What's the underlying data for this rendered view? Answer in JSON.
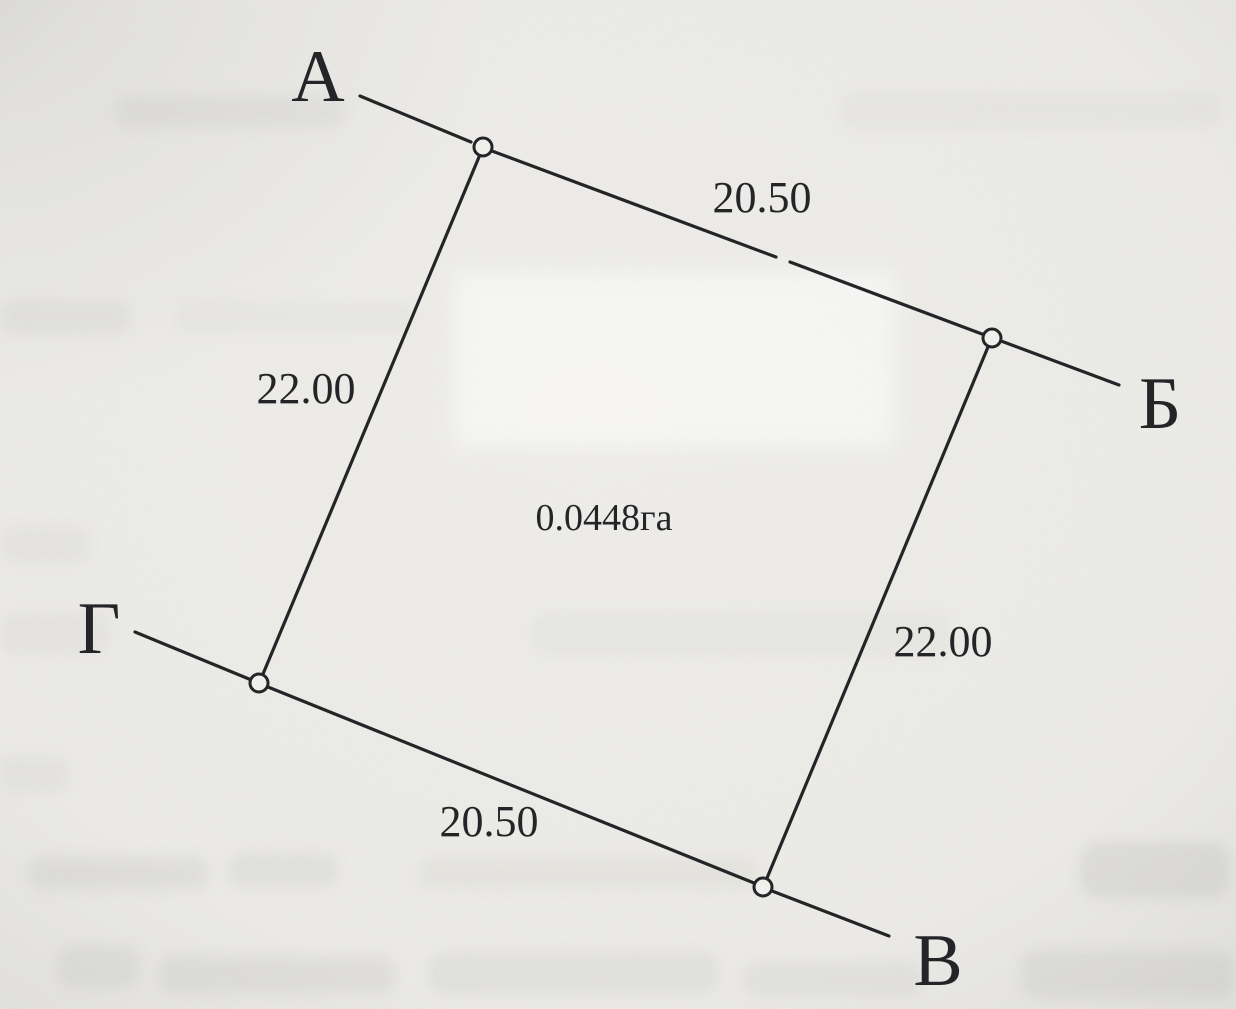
{
  "parcel_plan": {
    "area_label": "0.0448га",
    "corners": {
      "a": "А",
      "b": "Б",
      "v": "В",
      "g": "Г"
    },
    "side_lengths": {
      "top": "20.50",
      "right": "22.00",
      "bottom": "20.50",
      "left": "22.00"
    },
    "colors": {
      "ink": "#1e1e22",
      "paper": "#f0efec"
    }
  }
}
